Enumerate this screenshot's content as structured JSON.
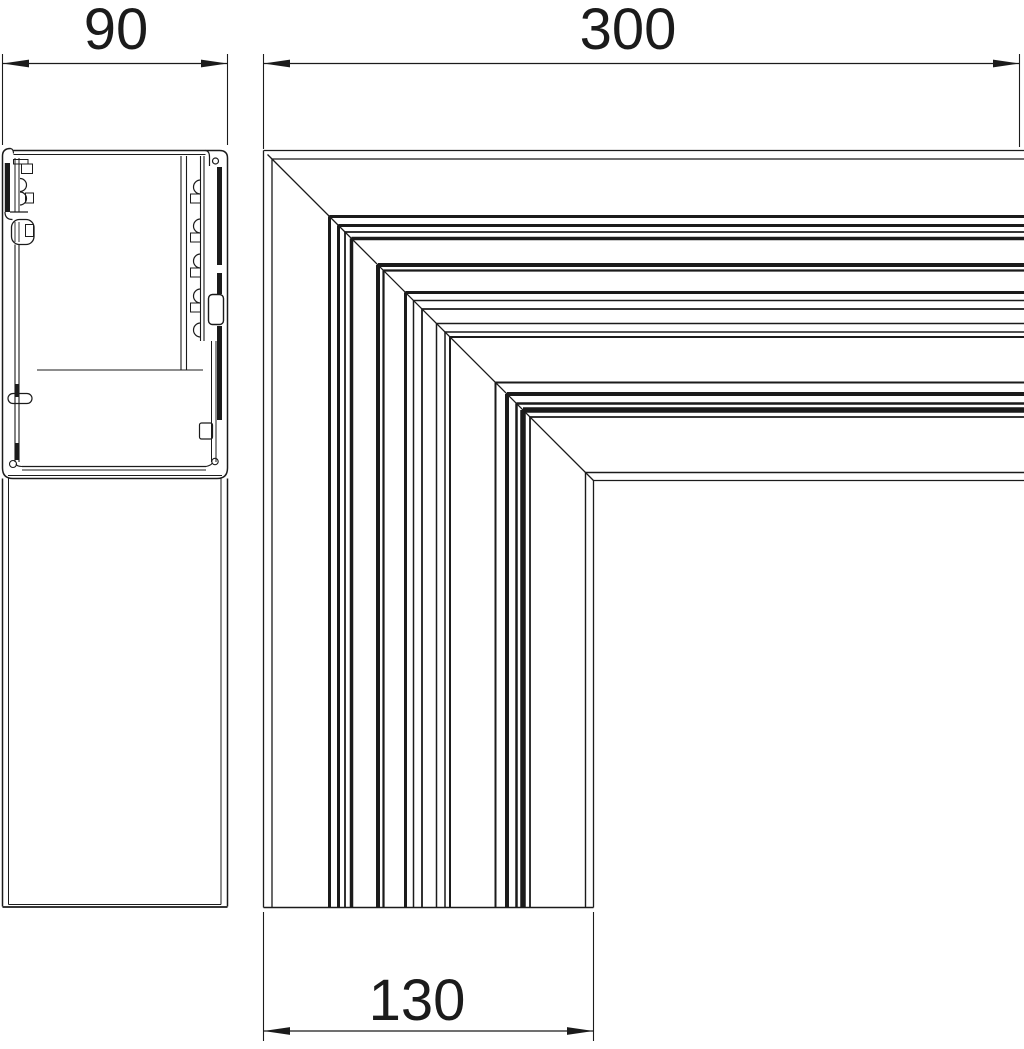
{
  "page": {
    "background": "#ffffff",
    "line_color": "#1b1b1b"
  },
  "dimensions": {
    "profile_width": {
      "label": "90"
    },
    "arm_length": {
      "label": "300"
    },
    "duct_width": {
      "label": "130"
    }
  },
  "corner_view": {
    "origin_x": 263.5,
    "origin_y": 150.5,
    "right_edge": 1026,
    "bottom_edge": 907.5,
    "diagonal_start_offset": 4,
    "max_offset": 330,
    "edge_lines": [
      {
        "o": 0,
        "w": 1.3
      },
      {
        "o": 8.5,
        "w": 1.3
      },
      {
        "o": 66,
        "w": 3.0
      },
      {
        "o": 75,
        "w": 3.0
      },
      {
        "o": 81.5,
        "w": 1.8
      },
      {
        "o": 88,
        "w": 3.5
      },
      {
        "o": 114.5,
        "w": 4.0
      },
      {
        "o": 120,
        "w": 2.2
      },
      {
        "o": 142,
        "w": 3.0
      },
      {
        "o": 150,
        "w": 1.5
      },
      {
        "o": 158.5,
        "w": 1.8
      },
      {
        "o": 173,
        "w": 1.5
      },
      {
        "o": 181.5,
        "w": 1.5
      },
      {
        "o": 186.5,
        "w": 2.0
      },
      {
        "o": 232,
        "w": 2.0
      },
      {
        "o": 243.5,
        "w": 4.0
      },
      {
        "o": 253,
        "w": 2.5
      },
      {
        "o": 259.5,
        "w": 5.5
      },
      {
        "o": 266.5,
        "w": 1.8
      },
      {
        "o": 322,
        "w": 1.4
      },
      {
        "o": 330,
        "w": 1.3
      }
    ]
  }
}
